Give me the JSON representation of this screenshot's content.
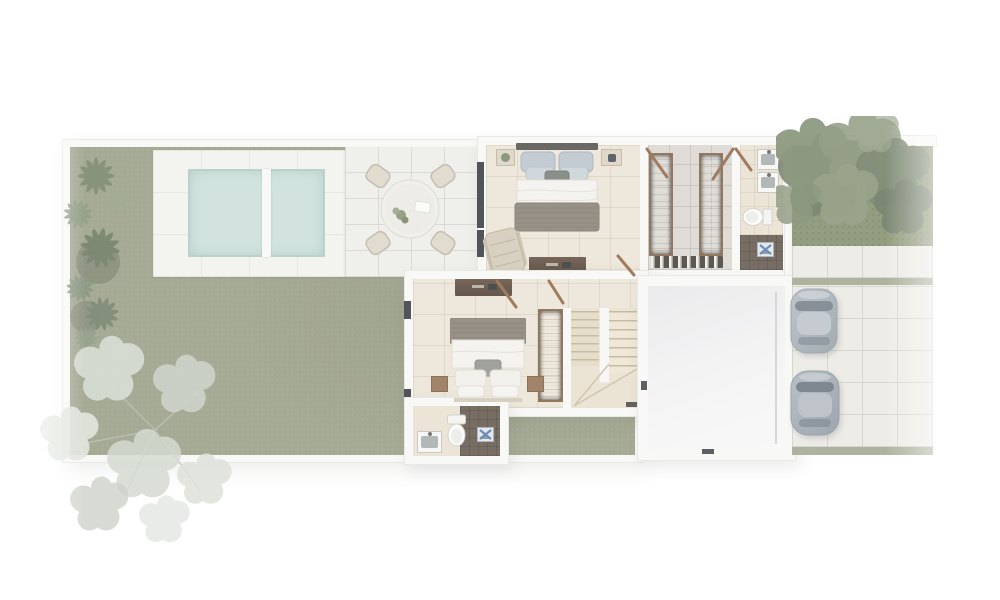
{
  "scene": {
    "kind": "architectural-floor-plan-top-view-render",
    "rooms": {
      "garden": "garden lawn",
      "pool": "swimming pool",
      "pool_deck": "pool deck",
      "patio": "outdoor dining patio",
      "bedroom1": "bedroom with double bed",
      "closet": "walk-in closet",
      "bathroom1": "bathroom with double vanity",
      "bedroom2": "second bedroom",
      "stairs": "u-shaped staircase",
      "bathroom2": "second bathroom",
      "flex_room": "empty open room",
      "entry": "side entry porch",
      "walkway": "paved walkway",
      "driveway": "parking driveway",
      "tree_bed": "planted tree bed"
    },
    "furniture": {
      "bed": "double bed with pillows and throw blanket",
      "nightstand": "nightstand",
      "lounge_chair": "lounge chair",
      "console": "wood console dresser",
      "clothing_rack": "clothing rack with hung garments",
      "shoe_row": "row of shoes",
      "sink": "square basin sink",
      "toilet": "toilet",
      "shower_fixture": "shower floor fixture",
      "dining_table": "round dining table",
      "dining_chair": "wicker dining chair",
      "car": "parked car",
      "palm": "palm plant",
      "tree": "tree canopy"
    },
    "counts": {
      "beds": 2,
      "bathrooms": 2,
      "sinks": 3,
      "toilets": 2,
      "showers": 2,
      "clothing_racks": 3,
      "dining_chairs": 4,
      "cars": 2,
      "pool_lanes": 2
    }
  },
  "colors": {
    "wall": "#f7f7f5",
    "wall_edge": "#e3e4e0",
    "lawn": "#8f957a",
    "pool_water": "#c7ddd7",
    "pool_edge": "#aac6bf",
    "deck": "#f1f1ed",
    "patio": "#ebebe6",
    "floor_beige": "#eae2d2",
    "floor_bath": "#e8dfce",
    "closet_floor": "#d7d4cf",
    "shower_dark": "#55493d",
    "stairs_floor": "#e7ddc9",
    "stairs_tread": "#b9aa8e",
    "big_room_floor": "#ededee",
    "driveway": "#eae8e2",
    "green_strip": "#99a086",
    "bed_green": "#79855f",
    "canopy_green": "#738163",
    "palm_green": "#68785a",
    "pale_tree": "#d0d7cc",
    "wood_door": "#8a5a38",
    "bed_blanket": "#7e7669",
    "bed_linen": "#f3f1ec",
    "pillow_blue": "#b4c0c8",
    "car_body": "#9aa4ad",
    "car_glass": "#5f6a74",
    "fixture_blue": "#4a6fa5"
  }
}
